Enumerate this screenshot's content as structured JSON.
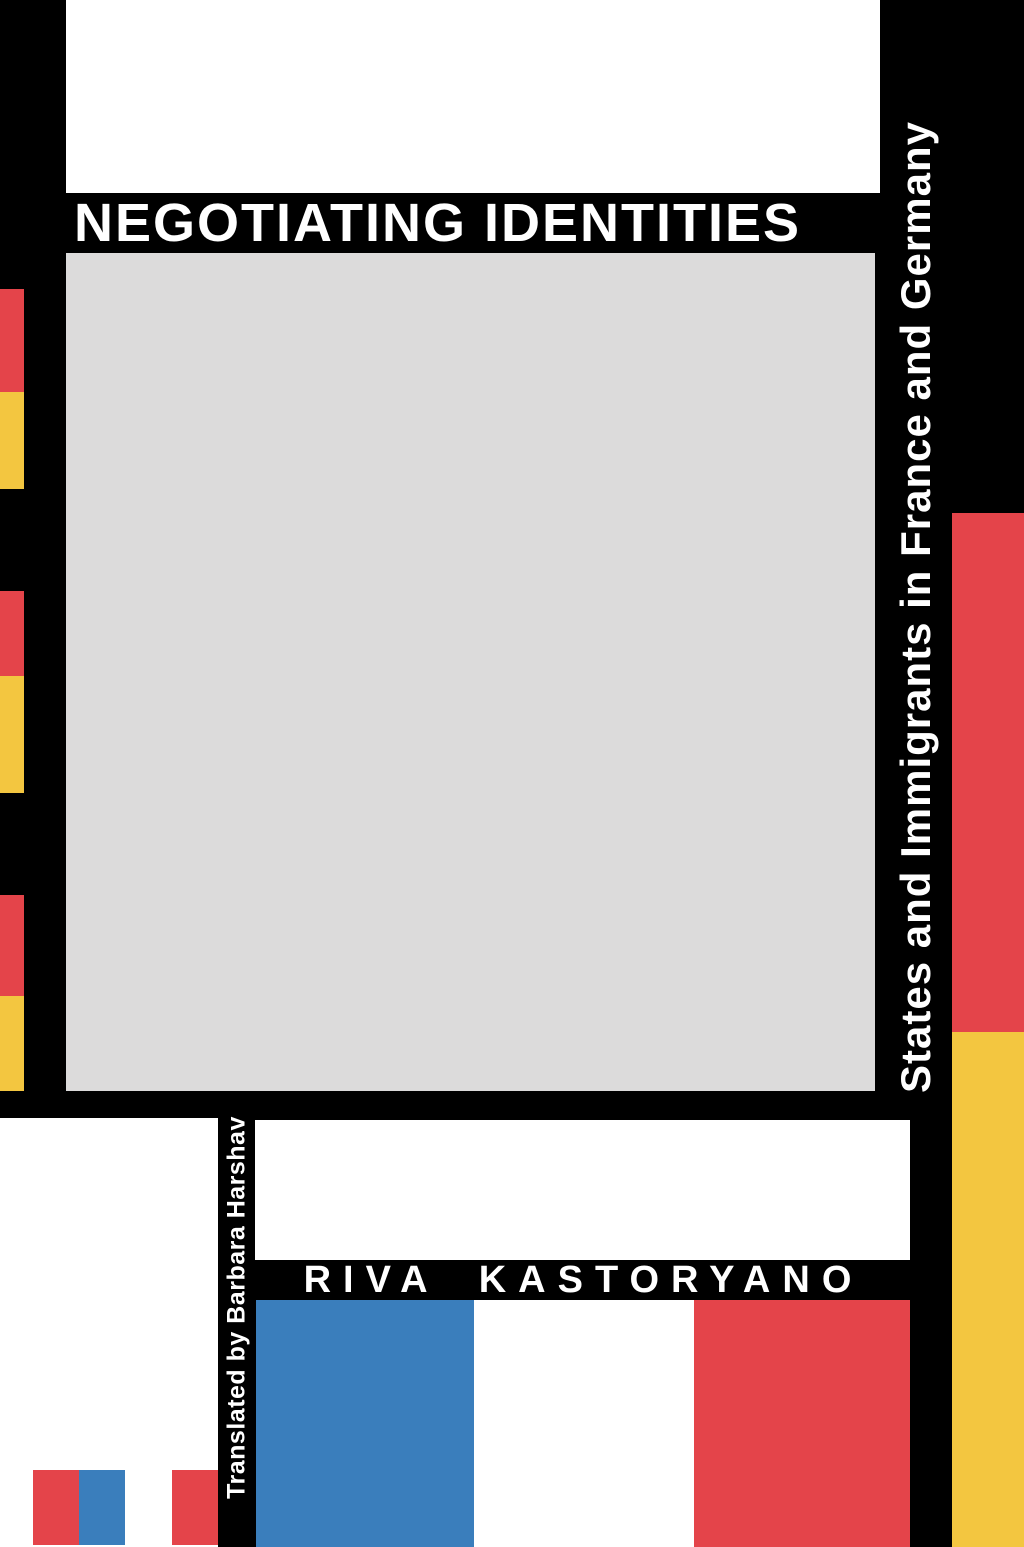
{
  "cover": {
    "title": "NEGOTIATING IDENTITIES",
    "subtitle_vertical": "States and Immigrants in France and Germany",
    "author": "RIVA KASTORYANO",
    "translator_vertical": "Translated by Barbara Harshav"
  },
  "colors": {
    "background": "#000000",
    "panel_white": "#ffffff",
    "panel_gray": "#dcdbdb",
    "accent_red": "#e4444a",
    "accent_yellow": "#f3c640",
    "accent_blue": "#3a7ebc",
    "title_text": "#ffffff",
    "author_text": "#ffffff"
  }
}
